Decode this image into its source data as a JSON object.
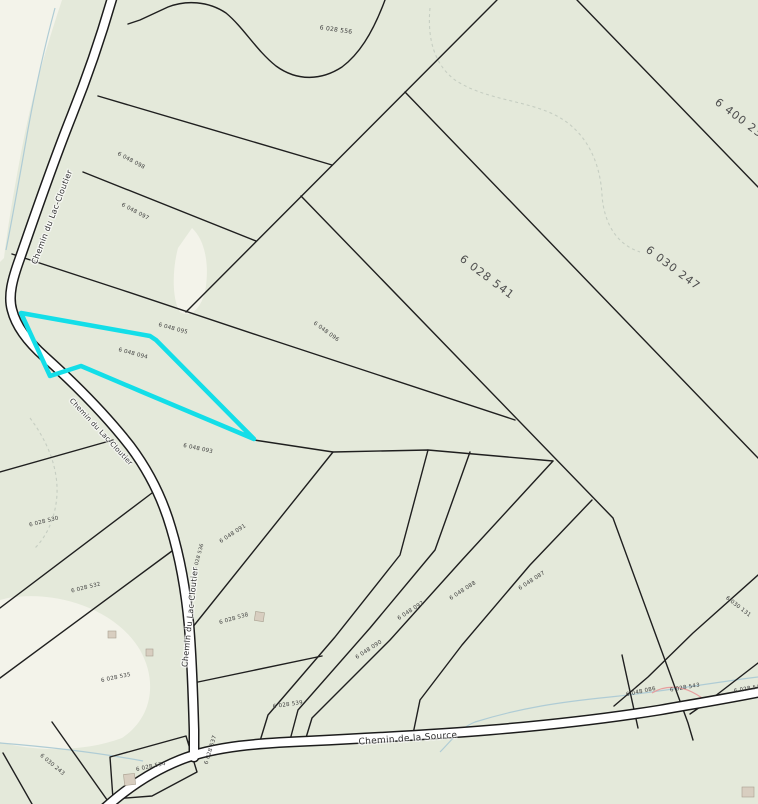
{
  "map": {
    "colors": {
      "land": "#e4e9da",
      "clearing": "#f3f3ea",
      "parcel_line": "#1f1f1f",
      "road_fill": "#ffffff",
      "road_casing": "#1c1c1c",
      "stream": "#afccd5",
      "contour_dash": "#c6cec2",
      "wetland_pink": "#e79e9e",
      "building_fill": "#d8cec0",
      "building_stroke": "#a9a090",
      "highlight": "#13dee8"
    },
    "road_labels": [
      {
        "text": "Chemin du Lac-Cloutier",
        "x": 52,
        "y": 217,
        "rot": -69,
        "size": 8
      },
      {
        "text": "Chemin du Lac-Cloutier",
        "x": 101,
        "y": 432,
        "rot": 47,
        "size": 7
      },
      {
        "text": "Chemin du Lac-Cloutier",
        "x": 190,
        "y": 617,
        "rot": -84,
        "size": 8
      },
      {
        "text": "Chemin de la Source",
        "x": 408,
        "y": 739,
        "rot": -4,
        "size": 9
      }
    ],
    "parcel_labels": [
      {
        "text": "6 028 556",
        "x": 336,
        "y": 30,
        "rot": 8,
        "size": 6,
        "big": false
      },
      {
        "text": "6 400 23",
        "x": 739,
        "y": 118,
        "rot": 37,
        "size": 11,
        "big": true
      },
      {
        "text": "6 030 247",
        "x": 673,
        "y": 268,
        "rot": 37,
        "size": 11,
        "big": true
      },
      {
        "text": "6 028 541",
        "x": 487,
        "y": 277,
        "rot": 37,
        "size": 11,
        "big": true
      },
      {
        "text": "6 048 098",
        "x": 131,
        "y": 161,
        "rot": 28,
        "size": 5.5,
        "big": false
      },
      {
        "text": "6 048 097",
        "x": 135,
        "y": 212,
        "rot": 28,
        "size": 5.5,
        "big": false
      },
      {
        "text": "6 048 095",
        "x": 173,
        "y": 329,
        "rot": 15,
        "size": 5.5,
        "big": false
      },
      {
        "text": "6 048 094",
        "x": 133,
        "y": 354,
        "rot": 15,
        "size": 5.5,
        "big": false
      },
      {
        "text": "6 048 096",
        "x": 326,
        "y": 332,
        "rot": 36,
        "size": 5.5,
        "big": false
      },
      {
        "text": "6 048 093",
        "x": 198,
        "y": 449,
        "rot": 12,
        "size": 5.5,
        "big": false
      },
      {
        "text": "6 028 530",
        "x": 44,
        "y": 522,
        "rot": -14,
        "size": 5.5,
        "big": false
      },
      {
        "text": "6 028 532",
        "x": 86,
        "y": 588,
        "rot": -14,
        "size": 5.5,
        "big": false
      },
      {
        "text": "6 048 091",
        "x": 233,
        "y": 534,
        "rot": -33,
        "size": 5.5,
        "big": false
      },
      {
        "text": "6 048 090",
        "x": 369,
        "y": 650,
        "rot": -33,
        "size": 5.5,
        "big": false
      },
      {
        "text": "6 048 092",
        "x": 411,
        "y": 611,
        "rot": -33,
        "size": 5.5,
        "big": false
      },
      {
        "text": "6 048 088",
        "x": 463,
        "y": 591,
        "rot": -33,
        "size": 5.5,
        "big": false
      },
      {
        "text": "6 048 087",
        "x": 532,
        "y": 581,
        "rot": -33,
        "size": 5.5,
        "big": false
      },
      {
        "text": "6 028 538",
        "x": 234,
        "y": 619,
        "rot": -16,
        "size": 5.5,
        "big": false
      },
      {
        "text": "6 028 535",
        "x": 116,
        "y": 678,
        "rot": -12,
        "size": 5.5,
        "big": false
      },
      {
        "text": "6 028 539",
        "x": 288,
        "y": 705,
        "rot": -8,
        "size": 5.5,
        "big": false
      },
      {
        "text": "6 028 534",
        "x": 151,
        "y": 767,
        "rot": -12,
        "size": 5.5,
        "big": false
      },
      {
        "text": "6 030 243",
        "x": 52,
        "y": 765,
        "rot": 40,
        "size": 5.5,
        "big": false
      },
      {
        "text": "6 028 537",
        "x": 211,
        "y": 750,
        "rot": -73,
        "size": 5.5,
        "big": false
      },
      {
        "text": "6 028 536",
        "x": 199,
        "y": 557,
        "rot": -75,
        "size": 5,
        "big": false
      },
      {
        "text": "6 030 131",
        "x": 738,
        "y": 607,
        "rot": 38,
        "size": 5.5,
        "big": false
      },
      {
        "text": "6 048 086",
        "x": 641,
        "y": 692,
        "rot": -12,
        "size": 5.5,
        "big": false
      },
      {
        "text": "6 028 543",
        "x": 685,
        "y": 688,
        "rot": -10,
        "size": 5.5,
        "big": false
      },
      {
        "text": "6 028 545",
        "x": 749,
        "y": 689,
        "rot": -10,
        "size": 5.5,
        "big": false
      }
    ],
    "highlight_parcel": {
      "points": "21,313 150,336 156,340 254,439 140,391 81,366 50,376",
      "stroke_width": 4.5
    }
  }
}
